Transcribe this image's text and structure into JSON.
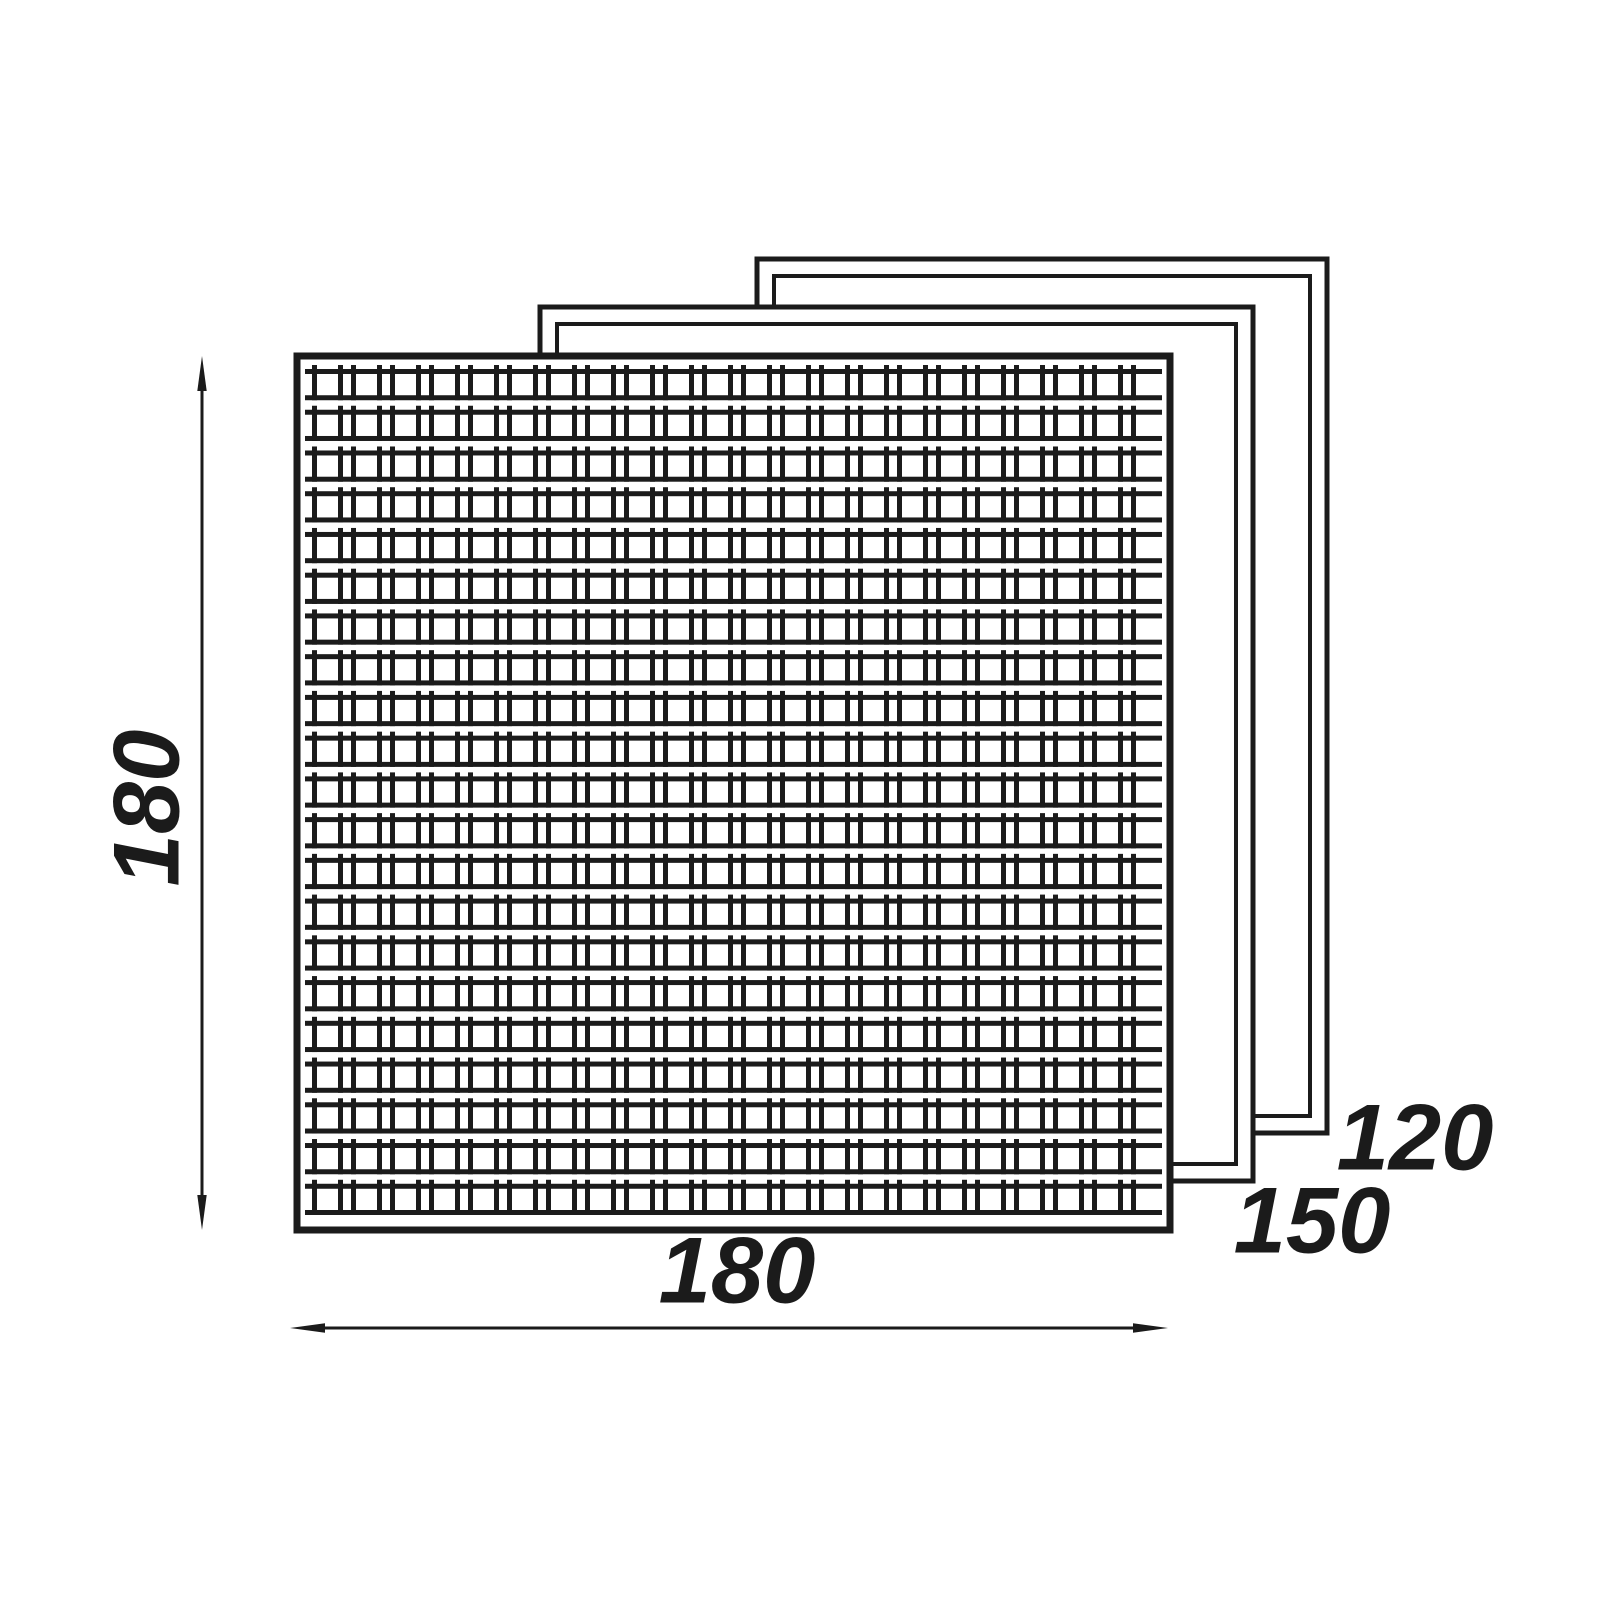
{
  "labels": {
    "front_height": "180",
    "front_width": "180",
    "middle_panel": "150",
    "back_panel": "120"
  },
  "colors": {
    "line": "#1b1b1b",
    "background": "#ffffff"
  },
  "panels": [
    {
      "name": "front",
      "size_label": "180",
      "type": "mesh-grid"
    },
    {
      "name": "middle",
      "size_label": "150",
      "type": "frame"
    },
    {
      "name": "back",
      "size_label": "120",
      "type": "frame"
    }
  ],
  "mesh": {
    "rows": 21,
    "row_gap": 9.5,
    "rail_thickness": 5,
    "bar_thickness": 5,
    "cell_pattern": [
      26,
      13
    ],
    "nub_height": 4
  }
}
